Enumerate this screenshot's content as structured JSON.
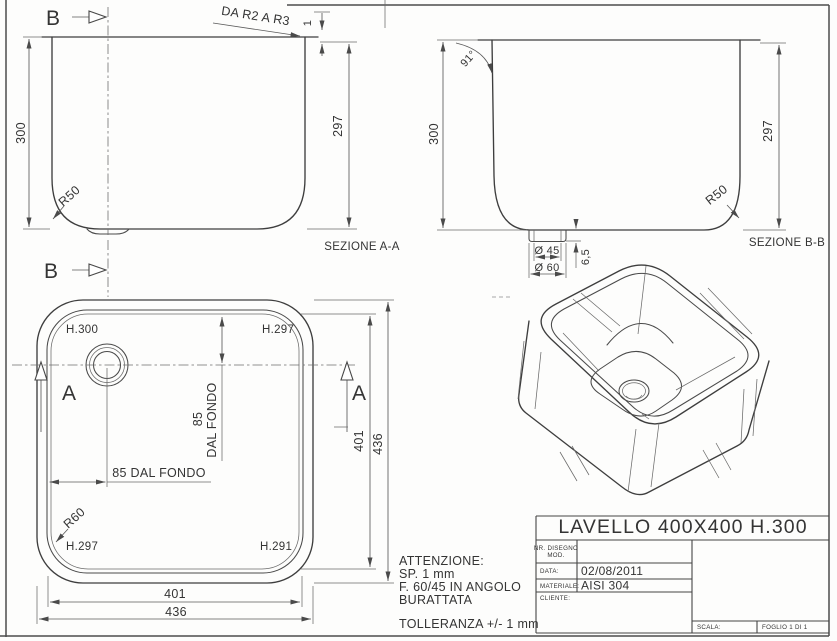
{
  "aa": {
    "marker_top": "B",
    "marker_bottom": "B",
    "edge_note": "DA R2 A R3",
    "thickness": "1",
    "height_outer": "300",
    "height_inner": "297",
    "corner_radius": "R50",
    "label": "SEZIONE A-A"
  },
  "bb": {
    "angle": "91°",
    "height_outer": "300",
    "height_inner": "297",
    "corner_radius": "R50",
    "label": "SEZIONE B-B",
    "drain_inner_dia": "Ø 45",
    "drain_outer_dia": "Ø 60",
    "drain_depth": "6,5"
  },
  "plan": {
    "marker_a_left": "A",
    "marker_a_right": "A",
    "h_top_left": "H.300",
    "h_top_right": "H.297",
    "h_bottom_left": "H.297",
    "h_bottom_right": "H.291",
    "corner_radius": "R60",
    "drain_offset_num": "85",
    "drain_offset_word": "DAL FONDO",
    "drain_offset_h": "85 DAL FONDO",
    "width_inner": "401",
    "width_outer": "436",
    "depth_inner": "401",
    "depth_outer": "436"
  },
  "notes": {
    "l1": "ATTENZIONE:",
    "l2": "SP. 1 mm",
    "l3": "F. 60/45 IN ANGOLO",
    "l4": "BURATTATA",
    "l5": "TOLLERANZA +/- 1 mm"
  },
  "titleblock": {
    "title": "LAVELLO 400X400 H.300",
    "nr_label1": "NR. DISEGNO",
    "nr_label2": "MOD.",
    "date_label": "DATA:",
    "date_value": "02/08/2011",
    "material_label": "MATERIALE:",
    "material_value": "AISI 304",
    "client_label": "CLIENTE:",
    "scale_label": "SCALA:",
    "sheet_label": "FOGLIO 1 DI 1"
  }
}
